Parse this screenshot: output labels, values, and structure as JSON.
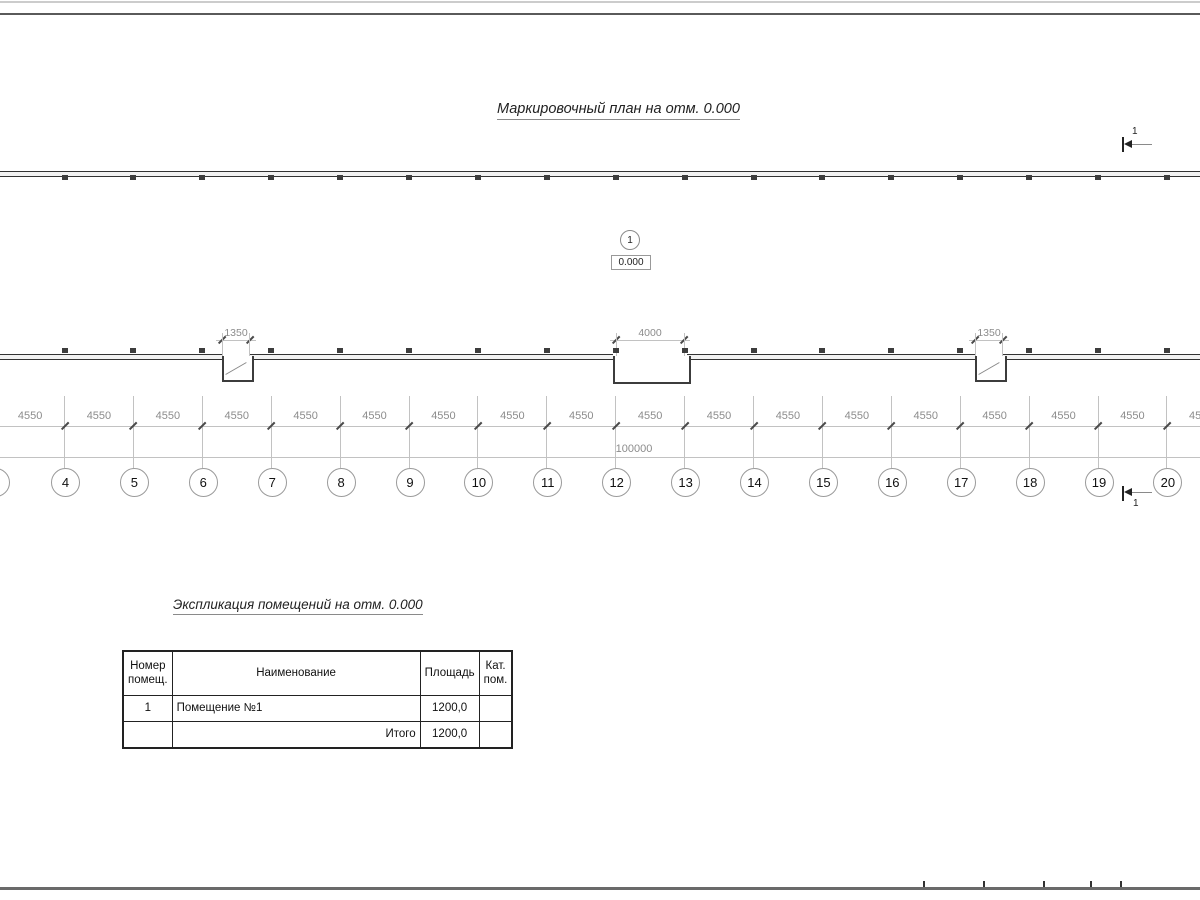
{
  "drawing": {
    "plan_title": "Маркировочный план на отм. 0.000",
    "schedule_title": "Экспликация помещений на отм. 0.000"
  },
  "section_marker": {
    "top_label": "1",
    "bottom_label": "1"
  },
  "room_marker": {
    "number": "1",
    "elevation": "0.000"
  },
  "grid": {
    "numbers": [
      "4",
      "5",
      "6",
      "7",
      "8",
      "9",
      "10",
      "11",
      "12",
      "13",
      "14",
      "15",
      "16",
      "17",
      "18",
      "19",
      "20"
    ],
    "bay_label": "4550",
    "total_label": "100000"
  },
  "openings": [
    {
      "width_label": "1350"
    },
    {
      "width_label": "4000"
    },
    {
      "width_label": "1350"
    }
  ],
  "schedule_table": {
    "headers": {
      "number": "Номер\nпомещ.",
      "name": "Наименование",
      "area": "Площадь",
      "category": "Кат.\nпом."
    },
    "rows": [
      {
        "number": "1",
        "name": "Помещение №1",
        "area": "1200,0",
        "category": ""
      }
    ],
    "total": {
      "label": "Итого",
      "value": "1200,0"
    }
  }
}
